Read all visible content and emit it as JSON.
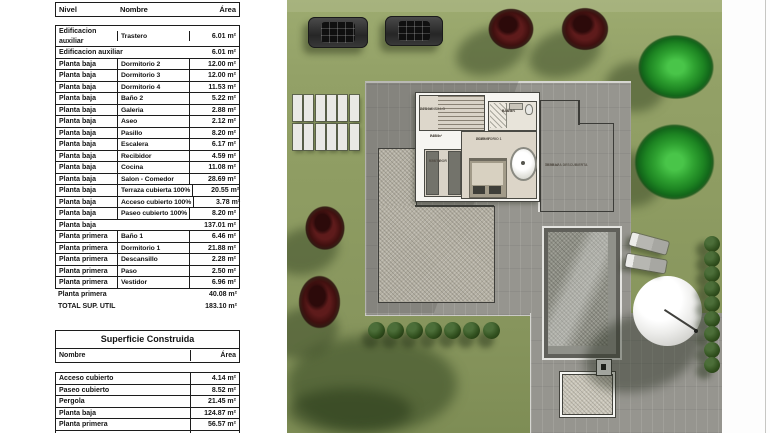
{
  "tables": {
    "util": {
      "headers": [
        "Nivel",
        "Nombre",
        "Área"
      ],
      "body_rows": [
        {
          "kind": "data",
          "nivel": "Edificacion auxiliar",
          "nombre": "Trastero",
          "area": "6.01 m²"
        },
        {
          "kind": "summary",
          "nivel": "Edificacion auxiliar",
          "area": "6.01 m²"
        },
        {
          "kind": "data",
          "nivel": "Planta baja",
          "nombre": "Dormitorio 2",
          "area": "12.00 m²"
        },
        {
          "kind": "data",
          "nivel": "Planta baja",
          "nombre": "Dormitorio 3",
          "area": "12.00 m²"
        },
        {
          "kind": "data",
          "nivel": "Planta baja",
          "nombre": "Dormitorio 4",
          "area": "11.53 m²"
        },
        {
          "kind": "data",
          "nivel": "Planta baja",
          "nombre": "Baño 2",
          "area": "5.22 m²"
        },
        {
          "kind": "data",
          "nivel": "Planta baja",
          "nombre": "Galeria",
          "area": "2.88 m²"
        },
        {
          "kind": "data",
          "nivel": "Planta baja",
          "nombre": "Aseo",
          "area": "2.12 m²"
        },
        {
          "kind": "data",
          "nivel": "Planta baja",
          "nombre": "Pasillo",
          "area": "8.20 m²"
        },
        {
          "kind": "data",
          "nivel": "Planta baja",
          "nombre": "Escalera",
          "area": "6.17 m²"
        },
        {
          "kind": "data",
          "nivel": "Planta baja",
          "nombre": "Recibidor",
          "area": "4.59 m²"
        },
        {
          "kind": "data",
          "nivel": "Planta baja",
          "nombre": "Cocina",
          "area": "11.08 m²"
        },
        {
          "kind": "data",
          "nivel": "Planta baja",
          "nombre": "Salon - Comedor",
          "area": "28.69 m²"
        },
        {
          "kind": "data",
          "nivel": "Planta baja",
          "nombre": "Terraza cubierta 100%",
          "area": "20.55 m²"
        },
        {
          "kind": "data",
          "nivel": "Planta baja",
          "nombre": "Acceso cubierto 100%",
          "area": "3.78 m²"
        },
        {
          "kind": "data",
          "nivel": "Planta baja",
          "nombre": "Paseo cubierto 100%",
          "area": "8.20 m²"
        },
        {
          "kind": "summary",
          "nivel": "Planta baja",
          "area": "137.01 m²"
        },
        {
          "kind": "data",
          "nivel": "Planta primera",
          "nombre": "Baño 1",
          "area": "6.46 m²"
        },
        {
          "kind": "data",
          "nivel": "Planta primera",
          "nombre": "Dormitorio 1",
          "area": "21.88 m²"
        },
        {
          "kind": "data",
          "nivel": "Planta primera",
          "nombre": "Descansillo",
          "area": "2.28 m²"
        },
        {
          "kind": "data",
          "nivel": "Planta primera",
          "nombre": "Paso",
          "area": "2.50 m²"
        },
        {
          "kind": "data",
          "nivel": "Planta primera",
          "nombre": "Vestidor",
          "area": "6.96 m²"
        }
      ],
      "footer_rows": [
        {
          "nivel": "Planta primera",
          "area": "40.08 m²"
        },
        {
          "nivel": "TOTAL SUP. UTIL",
          "area": "183.10 m²"
        }
      ]
    },
    "construida": {
      "title": "Superficie Construida",
      "headers": [
        "Nombre",
        "Área"
      ],
      "rows": [
        {
          "nombre": "Acceso cubierto",
          "area": "4.14 m²"
        },
        {
          "nombre": "Paseo cubierto",
          "area": "8.52 m²"
        },
        {
          "nombre": "Pergola",
          "area": "21.45 m²"
        },
        {
          "nombre": "Planta baja",
          "area": "124.87 m²"
        },
        {
          "nombre": "Planta primera",
          "area": "56.57 m²"
        },
        {
          "nombre": "Trastero",
          "area": "9.17 m²"
        }
      ]
    }
  },
  "plan": {
    "rooms": {
      "descansillo": {
        "name": "DESCANSILLO",
        "area": "2.28 m²"
      },
      "paso": {
        "name": "PASO",
        "area": "2.50 m²"
      },
      "bano1": {
        "name": "BAÑO 1",
        "area": "6.46 m²"
      },
      "vestidor": {
        "name": "VESTIDOR",
        "area": "6.96 m²"
      },
      "dormitorio1": {
        "name": "DORMITORIO 1",
        "area": "21.88 m²"
      },
      "terraza": {
        "name": "TERRAZA DESCUBIERTA",
        "area": "35.00 m²"
      }
    },
    "colors": {
      "grass": "#8e9c62",
      "deck": "#96958f",
      "mosaic": "#b3afa2",
      "pool_water": "#90918a",
      "tree_red": "#4a1212",
      "tree_green": "#28962a",
      "bush": "#2c451f"
    }
  }
}
